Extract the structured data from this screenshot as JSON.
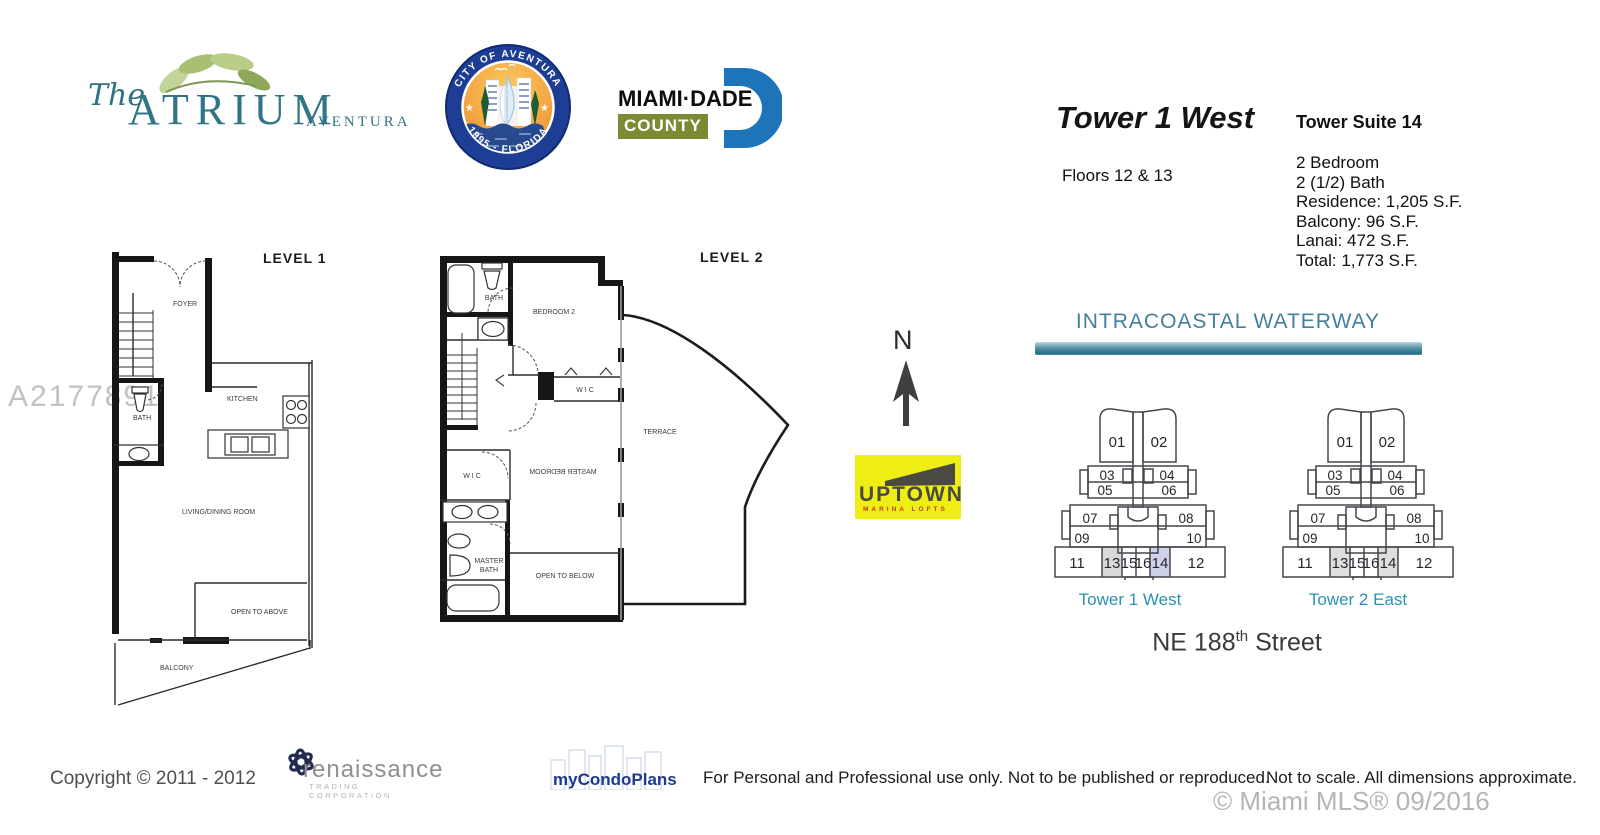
{
  "branding": {
    "atrium": {
      "script": "The",
      "name": "ATRIUM",
      "sub": "AVENTURA"
    },
    "seal": {
      "top": "CITY OF AVENTURA",
      "bottom": "1995 - FLORIDA"
    },
    "miami_dade": {
      "name": "MIAMI·DADE",
      "county": "COUNTY"
    },
    "uptown": {
      "name": "UPTOWN",
      "sub": "MARINA LOFTS"
    },
    "renaissance": {
      "name": "renaissance",
      "sub": "TRADING CORPORATION"
    },
    "mycondoplans": "myCondoPlans"
  },
  "header": {
    "tower_title": "Tower 1 West",
    "floors": "Floors 12 & 13",
    "suite_title": "Tower Suite 14",
    "details": [
      "2 Bedroom",
      "2 (1/2) Bath",
      "Residence: 1,205 S.F.",
      "Balcony: 96 S.F.",
      "Lanai: 472 S.F.",
      "Total: 1,773 S.F."
    ]
  },
  "watermark": "A2177891",
  "compass_label": "N",
  "floorplans": {
    "level1": {
      "title": "LEVEL 1",
      "foyer": "FOYER",
      "kitchen": "KITCHEN",
      "bath": "BATH",
      "living": "LIVING/DINING ROOM",
      "open_above": "OPEN TO ABOVE",
      "balcony": "BALCONY"
    },
    "level2": {
      "title": "LEVEL 2",
      "bath": "BATH",
      "bedroom2": "BEDROOM 2",
      "wic_upper": "W I C",
      "wic_lower": "W I C",
      "master_bedroom": "MASTER BEDROOM",
      "master_bath_line1": "MASTER",
      "master_bath_line2": "BATH",
      "open_below": "OPEN TO BELOW",
      "terrace": "TERRACE"
    }
  },
  "site_plan": {
    "waterway": "INTRACOASTAL WATERWAY",
    "street_prefix": "NE 188",
    "street_sup": "th",
    "street_suffix": " Street",
    "tower1": {
      "label": "Tower 1 West",
      "units": [
        "01",
        "02",
        "03",
        "04",
        "05",
        "06",
        "07",
        "08",
        "09",
        "10",
        "11",
        "13",
        "15",
        "16",
        "14",
        "12"
      ],
      "fill13": "#d9d9d9",
      "fill14": "#ced3ea"
    },
    "tower2": {
      "label": "Tower 2 East",
      "units": [
        "01",
        "02",
        "03",
        "04",
        "05",
        "06",
        "07",
        "08",
        "09",
        "10",
        "11",
        "13",
        "15",
        "16",
        "14",
        "12"
      ],
      "fill13": "#dedede",
      "fill14": "#dedede"
    }
  },
  "footer": {
    "copyright": "Copyright © 2011 - 2012",
    "usage": "For Personal and Professional use only.  Not to be published or reproduced.",
    "scale_note": "Not to scale.  All dimensions approximate.",
    "mls": "© Miami MLS® 09/2016"
  }
}
